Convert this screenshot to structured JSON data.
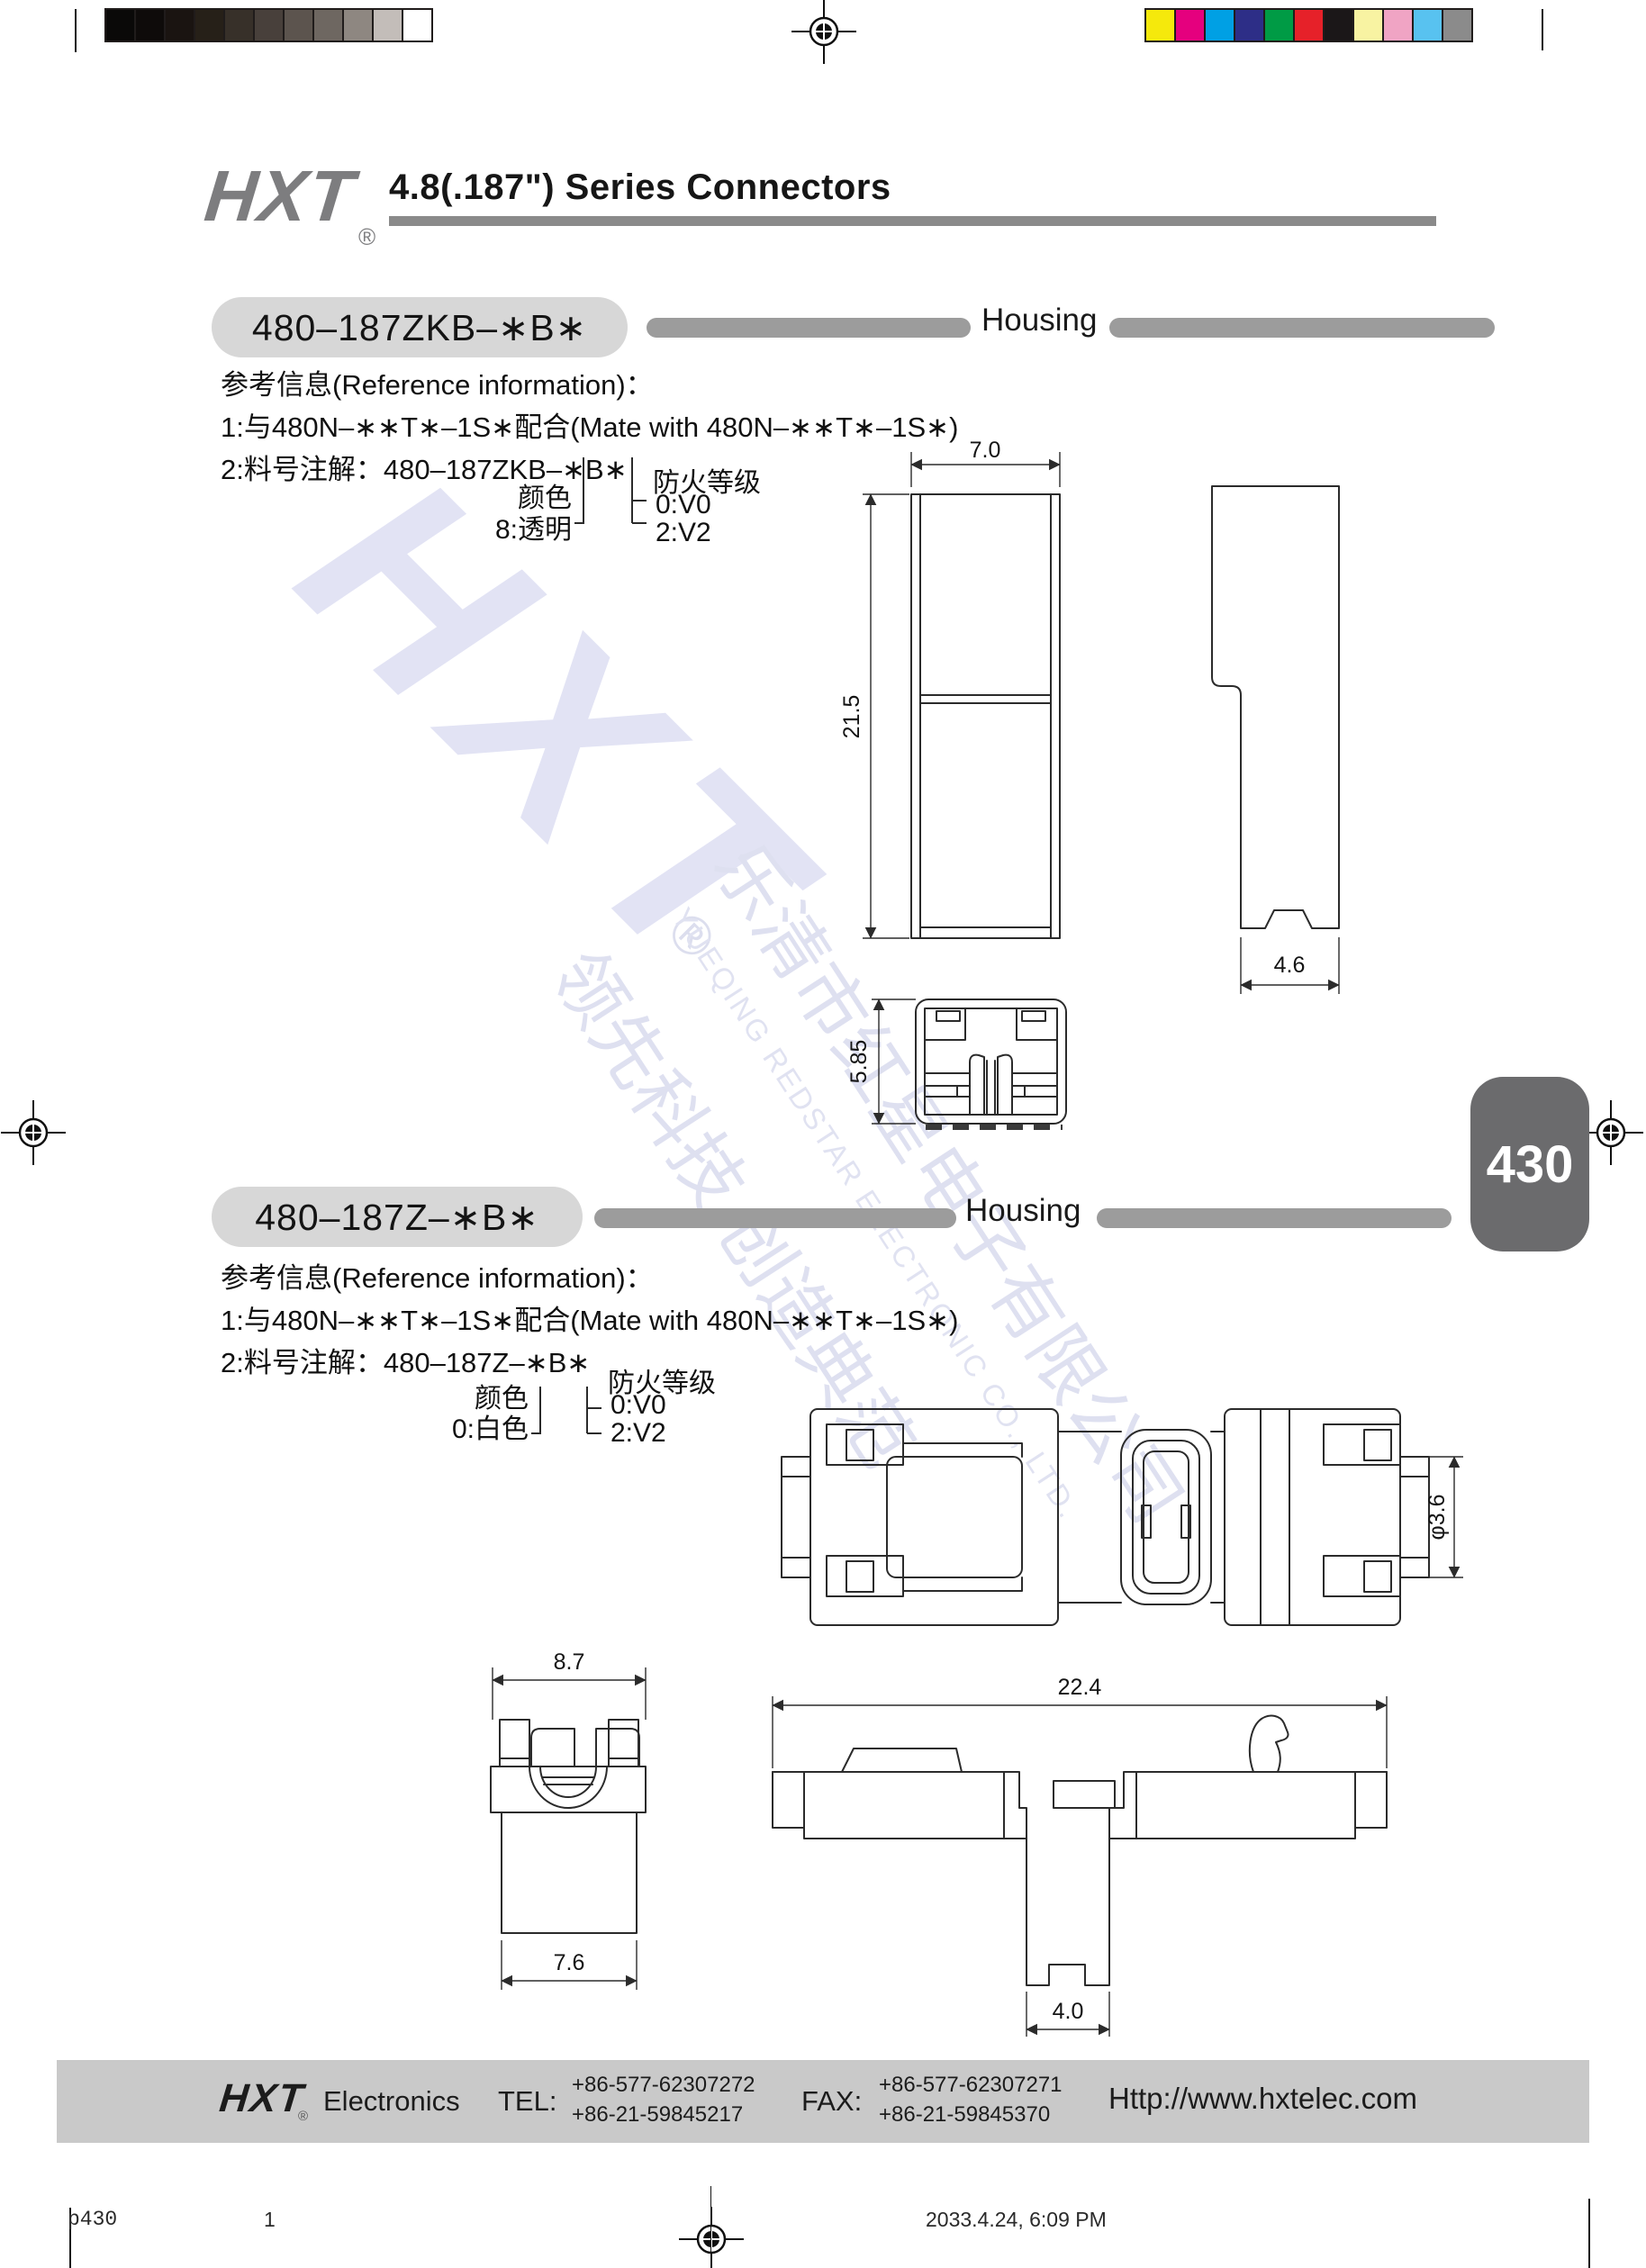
{
  "calibration": {
    "grayscale": [
      "#0a0908",
      "#0e0b0a",
      "#1a1411",
      "#262018",
      "#373029",
      "#48403b",
      "#5c544e",
      "#6e6761",
      "#8e8781",
      "#c3bdb9",
      "#ffffff"
    ],
    "colors": [
      "#f5e90c",
      "#e5007e",
      "#00a0e4",
      "#2d2e87",
      "#009b45",
      "#e62129",
      "#1b1718",
      "#f8f3a2",
      "#f0a4c4",
      "#58c2f0",
      "#8b8b8b"
    ]
  },
  "header": {
    "logo": "HXT",
    "registered": "®",
    "title": "4.8(.187\") Series Connectors"
  },
  "page_tab": {
    "number": "430"
  },
  "watermark": {
    "logo": "HXT",
    "registered": "®",
    "company_cn": "乐清市红星电子有限公司",
    "company_en": "YUEQING REDSTAR ELECTRONIC CO., LTD.",
    "slogan": "领先科技 创造典范"
  },
  "section1": {
    "part_number": "480–187ZKB–∗B∗",
    "category": "Housing",
    "ref_title": "参考信息(Reference information)：",
    "ref_line1": "1:与480N–∗∗T∗–1S∗配合(Mate with 480N–∗∗T∗–1S∗)",
    "ref_line2": "2:料号注解：480–187ZKB–∗B∗",
    "legend": {
      "color_label": "颜色",
      "color_value": "8:透明",
      "fire_label": "防火等级",
      "fire_v0": "0:V0",
      "fire_v2": "2:V2"
    },
    "dims": {
      "width": "7.0",
      "height": "21.5",
      "side_width": "4.6",
      "bottom_height": "5.85"
    }
  },
  "section2": {
    "part_number": "480–187Z–∗B∗",
    "category": "Housing",
    "ref_title": "参考信息(Reference information)：",
    "ref_line1": "1:与480N–∗∗T∗–1S∗配合(Mate with 480N–∗∗T∗–1S∗)",
    "ref_line2": "2:料号注解：480–187Z–∗B∗",
    "legend": {
      "color_label": "颜色",
      "color_value": "0:白色",
      "fire_label": "防火等级",
      "fire_v0": "0:V0",
      "fire_v2": "2:V2"
    },
    "dims": {
      "dia": "φ3.6",
      "front_top": "8.7",
      "front_bottom": "7.6",
      "side_length": "22.4",
      "stem_width": "4.0"
    }
  },
  "footer": {
    "logo": "HXT",
    "registered": "®",
    "company": "Electronics",
    "tel_label": "TEL:",
    "tel_line1": "+86-577-62307272",
    "tel_line2": "+86-21-59845217",
    "fax_label": "FAX:",
    "fax_line1": "+86-577-62307271",
    "fax_line2": "+86-21-59845370",
    "website": "Http://www.hxtelec.com"
  },
  "print_info": {
    "file_label": "p430",
    "page_number": "1",
    "datetime": "2033.4.24, 6:09 PM"
  }
}
